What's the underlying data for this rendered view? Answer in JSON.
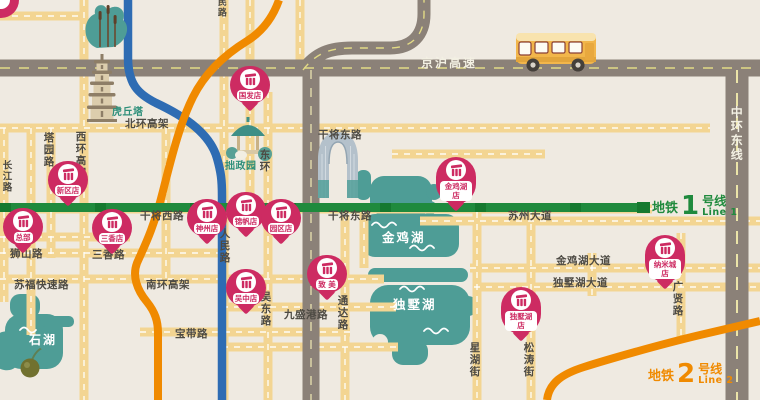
{
  "colors": {
    "background": "#EFEAE1",
    "road_yellow": "#F3D592",
    "road_gray": "#8B8178",
    "metro_line1_green": "#1F8A3D",
    "metro_line2_orange": "#F08A00",
    "river_blue": "#2E6CB3",
    "lake_teal": "#4E9D96",
    "pin_magenta": "#CD2B62"
  },
  "roads": {
    "jinghu_expwy": "京沪高速",
    "zhonghuan_east": "中环东线",
    "beihuan_viaduct": "北环高架",
    "xihuan_viaduct": "西环高架",
    "changjiang_rd": "长江路",
    "tayuan_rd": "塔园路",
    "ganjiang_west": "干将西路",
    "ganjiang_east_upper": "干将东路",
    "ganjiang_east": "干将东路",
    "suzhou_ave": "苏州大道",
    "shishan_rd": "狮山路",
    "sanxiang_rd": "三香路",
    "sufu_expwy": "苏福快速路",
    "nanhuan_viaduct": "南环高架",
    "baodai_rd": "宝带路",
    "renmin_rd": "人民路",
    "renmin_rd_top": "民路",
    "donghuan": "东环",
    "wudong_rd": "吴东路",
    "jiushenggang_rd": "九盛港路",
    "tongda_rd": "通达路",
    "xinghu_st": "星湖街",
    "songtao_st": "松涛街",
    "guangxian_rd": "广贤路",
    "jinjihu_ave": "金鸡湖大道",
    "dushuhu_ave": "独墅湖大道"
  },
  "lakes": {
    "jinji": "金鸡湖",
    "dushu": "独墅湖",
    "shi": "石湖"
  },
  "landmarks": {
    "pagoda": "虎丘塔",
    "garden": "拙政园"
  },
  "metro": {
    "line1": {
      "system": "地铁",
      "number": "1",
      "name": "号线",
      "name_en": "Line 1"
    },
    "line2": {
      "system": "地铁",
      "number": "2",
      "name": "号线",
      "name_en": "Line 2"
    }
  },
  "stores": [
    {
      "label": "总部"
    },
    {
      "label": "新区店"
    },
    {
      "label": "三香店"
    },
    {
      "label": "国发店"
    },
    {
      "label": "神州店"
    },
    {
      "label": "锦帆店"
    },
    {
      "label": "园区店"
    },
    {
      "label": "吴中店"
    },
    {
      "label": "致 美"
    },
    {
      "label": "金鸡湖店"
    },
    {
      "label": "独墅湖店"
    },
    {
      "label": "纳米城店"
    }
  ]
}
